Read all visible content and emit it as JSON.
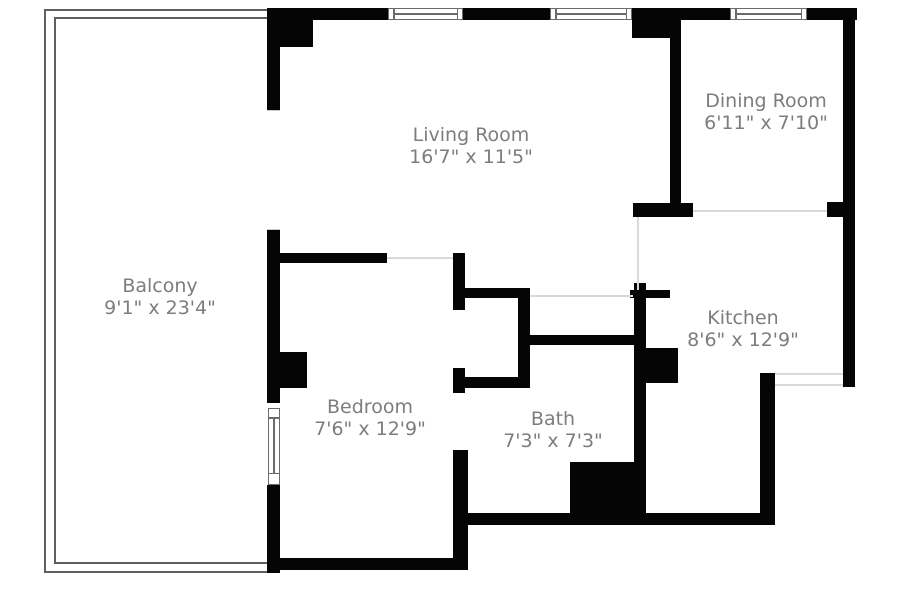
{
  "plan": {
    "title": "Apartment floor plan",
    "colors": {
      "background": "#ffffff",
      "wall": "#050505",
      "open_boundary_line": "#d9d9d9",
      "railing": "#5f5f5f",
      "window_frame": "#6b6b6b",
      "label_text": "#7d7d7d"
    }
  },
  "rooms": [
    {
      "name": "Living Room",
      "dims": "16'7\" x 11'5\""
    },
    {
      "name": "Dining Room",
      "dims": "6'11\" x 7'10\""
    },
    {
      "name": "Kitchen",
      "dims": "8'6\" x 12'9\""
    },
    {
      "name": "Bedroom",
      "dims": "7'6\" x 12'9\""
    },
    {
      "name": "Bath",
      "dims": "7'3\" x 7'3\""
    },
    {
      "name": "Balcony",
      "dims": "9'1\" x 23'4\""
    }
  ]
}
